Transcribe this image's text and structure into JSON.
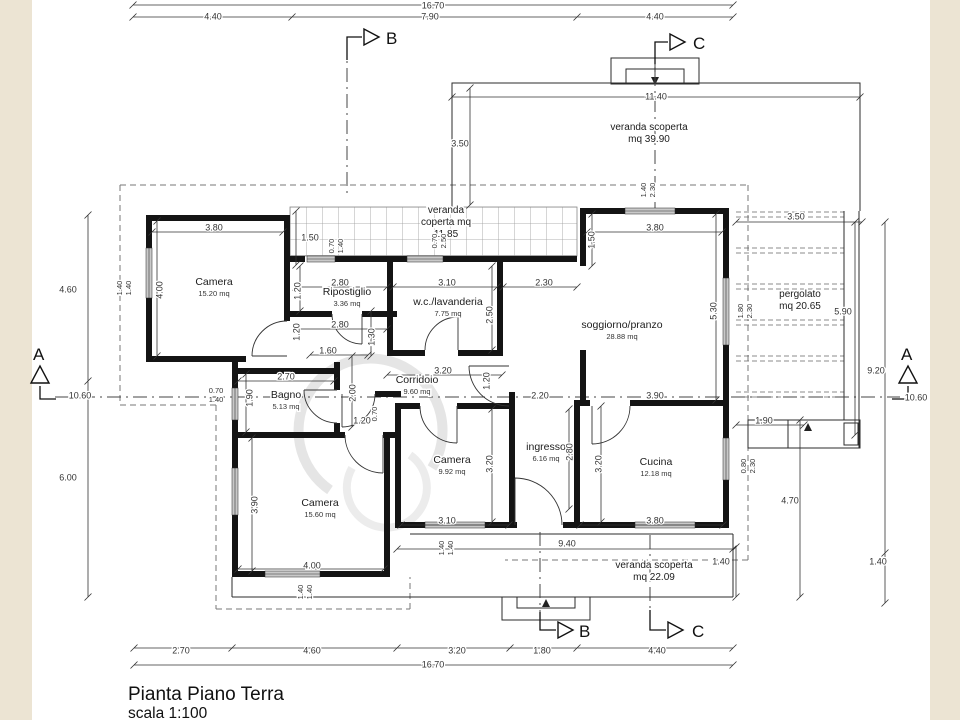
{
  "page": {
    "title_line1": "Pianta Piano Terra",
    "title_line2": "scala 1:100"
  },
  "colors": {
    "paper": "#ffffff",
    "margin": "#ece4d3",
    "wall": "#141414",
    "line": "#333333",
    "dash": "#777777",
    "window": "#c9c9c9",
    "hatch": "#999999",
    "watermark": "#e5e5e5"
  },
  "markers": {
    "a_left": "A",
    "a_right": "A",
    "b_top": "B",
    "b_bottom": "B",
    "c_top": "C",
    "c_bottom": "C"
  },
  "rooms": [
    {
      "name": "Camera",
      "area": "15.20 mq",
      "x": 214,
      "y": 285
    },
    {
      "name": "Ripostiglio",
      "area": "3.36 mq",
      "x": 347,
      "y": 295
    },
    {
      "name": "w.c./lavanderia",
      "area": "7.75 mq",
      "x": 448,
      "y": 305
    },
    {
      "name": "soggiorno/pranzo",
      "area": "28.88 mq",
      "x": 622,
      "y": 328
    },
    {
      "name": "Corridoio",
      "area": "9.60 mq",
      "x": 417,
      "y": 383
    },
    {
      "name": "Bagno",
      "area": "5.13 mq",
      "x": 286,
      "y": 398
    },
    {
      "name": "Camera",
      "area": "9.92 mq",
      "x": 452,
      "y": 463
    },
    {
      "name": "ingresso",
      "area": "6.16 mq",
      "x": 546,
      "y": 450
    },
    {
      "name": "Cucina",
      "area": "12.18 mq",
      "x": 656,
      "y": 465
    },
    {
      "name": "Camera",
      "area": "15.60 mq",
      "x": 320,
      "y": 506
    }
  ],
  "zones": [
    {
      "lines": [
        "veranda scoperta",
        "mq 39.90"
      ],
      "x": 649,
      "y": 130
    },
    {
      "lines": [
        "veranda",
        "coperta mq",
        "11.85"
      ],
      "x": 446,
      "y": 213
    },
    {
      "lines": [
        "pergolato",
        "mq 20.65"
      ],
      "x": 800,
      "y": 297
    },
    {
      "lines": [
        "veranda scoperta",
        "mq 22.09"
      ],
      "x": 654,
      "y": 568
    }
  ],
  "dims": [
    {
      "t": "16.70",
      "x": 433,
      "y": 6
    },
    {
      "t": "4.40",
      "x": 213,
      "y": 17
    },
    {
      "t": "7.90",
      "x": 430,
      "y": 17
    },
    {
      "t": "4.40",
      "x": 655,
      "y": 17
    },
    {
      "t": "11.40",
      "x": 656,
      "y": 97
    },
    {
      "t": "3.50",
      "x": 460,
      "y": 144
    },
    {
      "t": "3.50",
      "x": 796,
      "y": 217
    },
    {
      "t": "3.80",
      "x": 214,
      "y": 228
    },
    {
      "t": "3.80",
      "x": 655,
      "y": 228
    },
    {
      "t": "1.50",
      "x": 310,
      "y": 238
    },
    {
      "t": "1.40",
      "x": 644,
      "y": 190,
      "r": 1,
      "s": 1
    },
    {
      "t": "2.30",
      "x": 653,
      "y": 190,
      "r": 1,
      "s": 1
    },
    {
      "t": "0.70",
      "x": 332,
      "y": 246,
      "r": 1,
      "s": 1
    },
    {
      "t": "1.40",
      "x": 341,
      "y": 246,
      "r": 1,
      "s": 1
    },
    {
      "t": "0.70",
      "x": 435,
      "y": 241,
      "r": 1,
      "s": 1
    },
    {
      "t": "2.50",
      "x": 444,
      "y": 241,
      "r": 1,
      "s": 1
    },
    {
      "t": "1.50",
      "x": 592,
      "y": 240,
      "r": 1
    },
    {
      "t": "2.80",
      "x": 340,
      "y": 283
    },
    {
      "t": "3.10",
      "x": 447,
      "y": 283
    },
    {
      "t": "2.30",
      "x": 544,
      "y": 283
    },
    {
      "t": "4.60",
      "x": 68,
      "y": 290
    },
    {
      "t": "1.40",
      "x": 120,
      "y": 288,
      "r": 1,
      "s": 1
    },
    {
      "t": "1.40",
      "x": 129,
      "y": 288,
      "r": 1,
      "s": 1
    },
    {
      "t": "4.00",
      "x": 160,
      "y": 290,
      "r": 1
    },
    {
      "t": "1.20",
      "x": 298,
      "y": 291,
      "r": 1
    },
    {
      "t": "2.80",
      "x": 340,
      "y": 325
    },
    {
      "t": "1.20",
      "x": 297,
      "y": 332,
      "r": 1
    },
    {
      "t": "2.50",
      "x": 490,
      "y": 315,
      "r": 1
    },
    {
      "t": "5.30",
      "x": 714,
      "y": 311,
      "r": 1
    },
    {
      "t": "1.80",
      "x": 741,
      "y": 311,
      "r": 1,
      "s": 1
    },
    {
      "t": "2.30",
      "x": 750,
      "y": 311,
      "r": 1,
      "s": 1
    },
    {
      "t": "5.90",
      "x": 843,
      "y": 312
    },
    {
      "t": "1.30",
      "x": 372,
      "y": 337,
      "r": 1
    },
    {
      "t": "1.60",
      "x": 328,
      "y": 351
    },
    {
      "t": "3.20",
      "x": 443,
      "y": 371
    },
    {
      "t": "2.70",
      "x": 286,
      "y": 377
    },
    {
      "t": "1.90",
      "x": 250,
      "y": 398,
      "r": 1
    },
    {
      "t": "2.00",
      "x": 353,
      "y": 393,
      "r": 1
    },
    {
      "t": "1.20",
      "x": 487,
      "y": 381,
      "r": 1
    },
    {
      "t": "9.20",
      "x": 876,
      "y": 371
    },
    {
      "t": "10.60",
      "x": 80,
      "y": 396
    },
    {
      "t": "10.60",
      "x": 916,
      "y": 398
    },
    {
      "t": "2.20",
      "x": 540,
      "y": 396
    },
    {
      "t": "3.90",
      "x": 655,
      "y": 396
    },
    {
      "t": "0.70",
      "x": 216,
      "y": 391,
      "s": 1
    },
    {
      "t": "1.40",
      "x": 216,
      "y": 400,
      "s": 1
    },
    {
      "t": "1.20",
      "x": 362,
      "y": 421
    },
    {
      "t": "0.70",
      "x": 375,
      "y": 414,
      "r": 1,
      "s": 1
    },
    {
      "t": "1.90",
      "x": 764,
      "y": 421
    },
    {
      "t": "2.80",
      "x": 570,
      "y": 452,
      "r": 1
    },
    {
      "t": "3.20",
      "x": 490,
      "y": 464,
      "r": 1
    },
    {
      "t": "3.20",
      "x": 599,
      "y": 464,
      "r": 1
    },
    {
      "t": "0.80",
      "x": 744,
      "y": 466,
      "r": 1,
      "s": 1
    },
    {
      "t": "2.30",
      "x": 753,
      "y": 466,
      "r": 1,
      "s": 1
    },
    {
      "t": "6.00",
      "x": 68,
      "y": 478
    },
    {
      "t": "3.90",
      "x": 255,
      "y": 505,
      "r": 1
    },
    {
      "t": "4.70",
      "x": 790,
      "y": 501
    },
    {
      "t": "3.10",
      "x": 447,
      "y": 521
    },
    {
      "t": "3.80",
      "x": 655,
      "y": 521
    },
    {
      "t": "9.40",
      "x": 567,
      "y": 544
    },
    {
      "t": "1.40",
      "x": 442,
      "y": 548,
      "r": 1,
      "s": 1
    },
    {
      "t": "1.40",
      "x": 451,
      "y": 548,
      "r": 1,
      "s": 1
    },
    {
      "t": "1.40",
      "x": 721,
      "y": 562
    },
    {
      "t": "1.40",
      "x": 878,
      "y": 562
    },
    {
      "t": "4.00",
      "x": 312,
      "y": 566
    },
    {
      "t": "1.40",
      "x": 301,
      "y": 592,
      "r": 1,
      "s": 1
    },
    {
      "t": "1.40",
      "x": 310,
      "y": 592,
      "r": 1,
      "s": 1
    },
    {
      "t": "2.70",
      "x": 181,
      "y": 651
    },
    {
      "t": "4.60",
      "x": 312,
      "y": 651
    },
    {
      "t": "3.20",
      "x": 457,
      "y": 651
    },
    {
      "t": "1.80",
      "x": 542,
      "y": 651
    },
    {
      "t": "4.40",
      "x": 657,
      "y": 651
    },
    {
      "t": "16.70",
      "x": 433,
      "y": 665
    }
  ]
}
